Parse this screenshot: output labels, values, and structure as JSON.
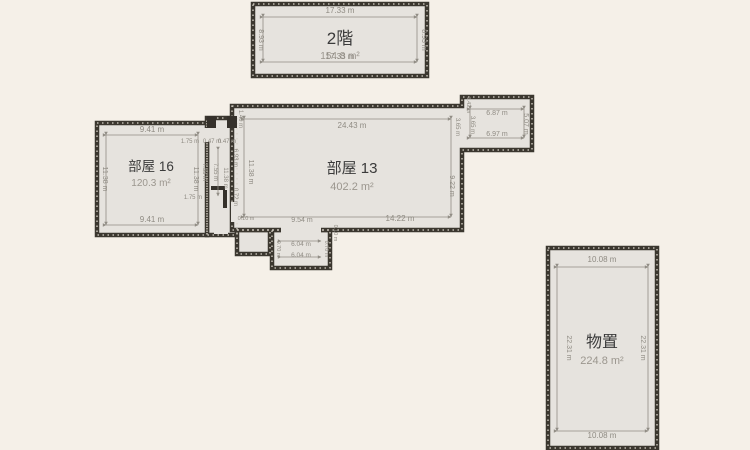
{
  "plan": {
    "unit": "m",
    "colors": {
      "background": "#f5f0e8",
      "floor_fill": "#e6e3de",
      "wall": "#3b372f",
      "dimension_text": "#8f8b83",
      "title_text": "#3b3b3b",
      "area_text": "#9b968e"
    },
    "rooms": [
      {
        "id": "floor2",
        "name": "2階",
        "area": "154.8 m²"
      },
      {
        "id": "room16",
        "name": "部屋 16",
        "area": "120.3 m²"
      },
      {
        "id": "room13",
        "name": "部屋 13",
        "area": "402.2 m²"
      },
      {
        "id": "storage",
        "name": "物置",
        "area": "224.8 m²"
      }
    ],
    "dimensions": [
      {
        "t": "17.33 m",
        "x": 340,
        "y": 13,
        "s": 8
      },
      {
        "t": "17.33 m",
        "x": 340,
        "y": 59,
        "s": 8
      },
      {
        "t": "8.93 m",
        "x": 259,
        "y": 40,
        "r": 90,
        "s": 7
      },
      {
        "t": "8.93 m",
        "x": 422,
        "y": 40,
        "r": 90,
        "s": 7
      },
      {
        "t": "9.41 m",
        "x": 152,
        "y": 132,
        "s": 8
      },
      {
        "t": "9.41 m",
        "x": 152,
        "y": 222,
        "s": 8
      },
      {
        "t": "11.38 m",
        "x": 103,
        "y": 179,
        "r": 90,
        "s": 7
      },
      {
        "t": "11.38 m",
        "x": 194,
        "y": 179,
        "r": 90,
        "s": 7
      },
      {
        "t": "1.75 m",
        "x": 190,
        "y": 143,
        "s": 6
      },
      {
        "t": "0.47 m",
        "x": 212,
        "y": 143,
        "s": 6
      },
      {
        "t": "0.47 m",
        "x": 227,
        "y": 143,
        "s": 6
      },
      {
        "t": "7.55 m",
        "x": 203,
        "y": 172,
        "r": 90,
        "s": 6
      },
      {
        "t": "7.55 m",
        "x": 214,
        "y": 172,
        "r": 90,
        "s": 6
      },
      {
        "t": "1.75 m",
        "x": 193,
        "y": 199,
        "s": 6
      },
      {
        "t": "11.38 m",
        "x": 224,
        "y": 178,
        "r": 90,
        "s": 6
      },
      {
        "t": "1.40 m",
        "x": 239,
        "y": 119,
        "r": 90,
        "s": 6
      },
      {
        "t": "24.43 m",
        "x": 352,
        "y": 128,
        "s": 8
      },
      {
        "t": "11.38 m",
        "x": 249,
        "y": 172,
        "r": 90,
        "s": 7
      },
      {
        "t": "6.93 m",
        "x": 234,
        "y": 158,
        "r": 90,
        "s": 6
      },
      {
        "t": "0.72 m",
        "x": 234,
        "y": 197,
        "r": 90,
        "s": 6
      },
      {
        "t": "9.22 m",
        "x": 450,
        "y": 186,
        "r": 90,
        "s": 7
      },
      {
        "t": "3.65 m",
        "x": 456,
        "y": 127,
        "r": 90,
        "s": 6
      },
      {
        "t": "9.54 m",
        "x": 302,
        "y": 222,
        "s": 7
      },
      {
        "t": "14.22 m",
        "x": 400,
        "y": 221,
        "s": 8
      },
      {
        "t": "0.10 m",
        "x": 246,
        "y": 220,
        "s": 5.5
      },
      {
        "t": "1.42 m",
        "x": 467,
        "y": 105,
        "r": 90,
        "s": 5.5
      },
      {
        "t": "3.65 m",
        "x": 471,
        "y": 125,
        "r": 90,
        "s": 6
      },
      {
        "t": "6.87 m",
        "x": 497,
        "y": 115,
        "s": 7
      },
      {
        "t": "6.97 m",
        "x": 497,
        "y": 136,
        "s": 7
      },
      {
        "t": "5.07 m",
        "x": 524,
        "y": 124,
        "r": 90,
        "s": 7
      },
      {
        "t": "6.04 m",
        "x": 301,
        "y": 246,
        "s": 6.5
      },
      {
        "t": "6.04 m",
        "x": 301,
        "y": 257,
        "s": 6.5
      },
      {
        "t": "0.70 m",
        "x": 277,
        "y": 249,
        "r": 90,
        "s": 5.5
      },
      {
        "t": "0.70 m",
        "x": 325,
        "y": 249,
        "r": 90,
        "s": 5.5
      },
      {
        "t": "0.10 m",
        "x": 334,
        "y": 233,
        "r": 90,
        "s": 5.5
      },
      {
        "t": "10.08 m",
        "x": 602,
        "y": 262,
        "s": 8
      },
      {
        "t": "10.08 m",
        "x": 602,
        "y": 438,
        "s": 8
      },
      {
        "t": "22.31 m",
        "x": 567,
        "y": 348,
        "r": 90,
        "s": 7
      },
      {
        "t": "22.31 m",
        "x": 641,
        "y": 348,
        "r": 90,
        "s": 7
      }
    ]
  }
}
